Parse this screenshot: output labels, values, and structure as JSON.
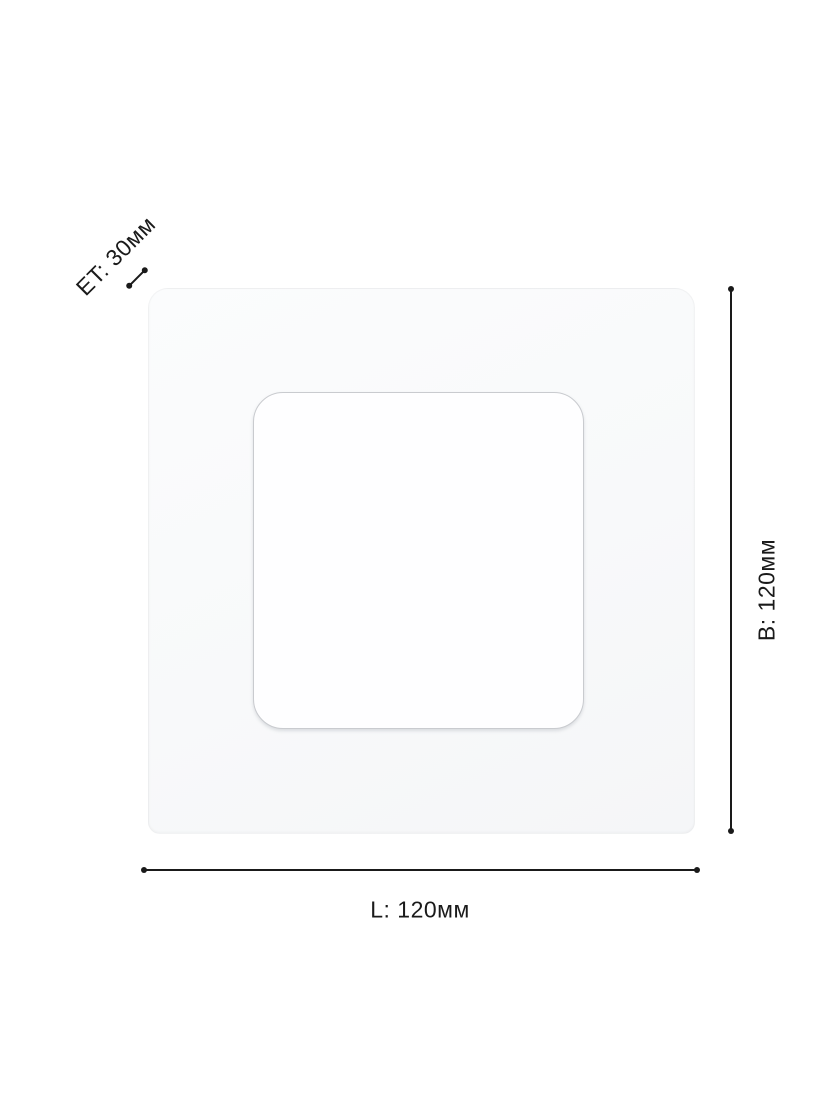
{
  "diagram": {
    "kind": "product-dimension-diagram",
    "subject": "square recessed panel light, top view",
    "labels": {
      "length": "L: 120мм",
      "height": "B: 120мм",
      "depth": "ET: 30мм"
    }
  },
  "colors": {
    "background": "#ffffff",
    "line": "#1a1a1a",
    "panel_face": "#f8f9fa",
    "inner_face": "#fefeff",
    "inner_border": "#c9cbcf"
  }
}
